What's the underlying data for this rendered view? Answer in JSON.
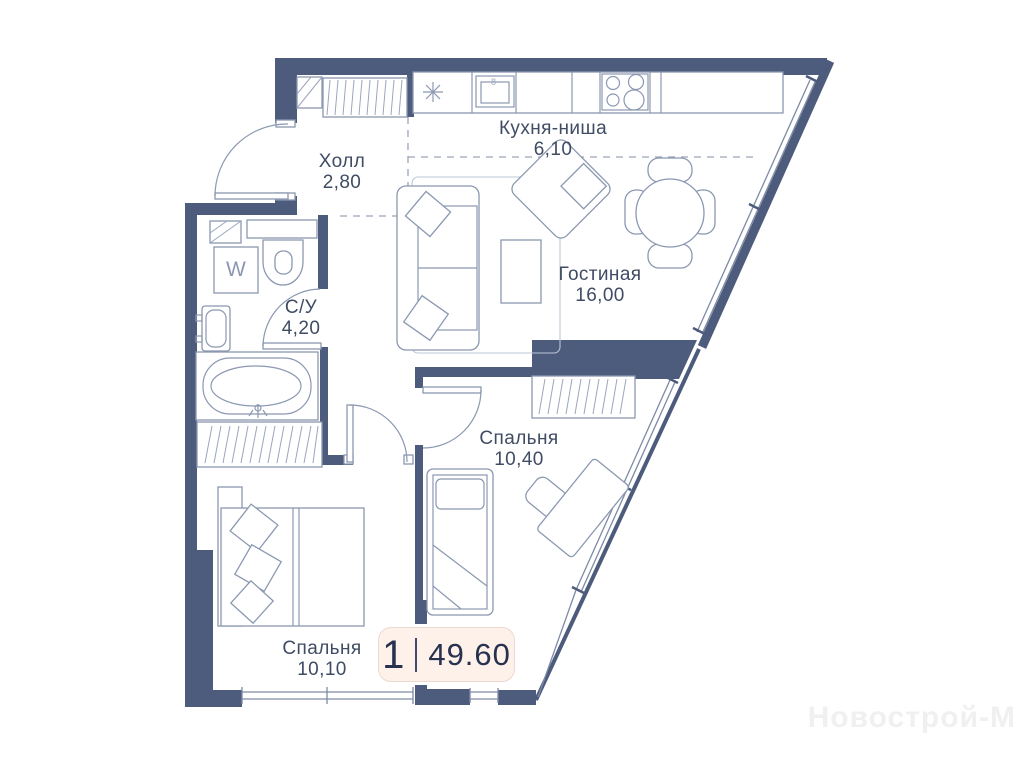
{
  "plan": {
    "rooms": [
      {
        "id": "kitchen",
        "name": "Кухня-ниша",
        "area": "6,10"
      },
      {
        "id": "hall",
        "name": "Холл",
        "area": "2,80"
      },
      {
        "id": "bathroom",
        "name": "С/У",
        "area": "4,20"
      },
      {
        "id": "living",
        "name": "Гостиная",
        "area": "16,00"
      },
      {
        "id": "bedroom-2",
        "name": "Спальня",
        "area": "10,40"
      },
      {
        "id": "bedroom-1",
        "name": "Спальня",
        "area": "10,10"
      }
    ],
    "badge": {
      "rooms_count": "1",
      "total_area": "49.60"
    },
    "appliances": {
      "washer_label": "W",
      "oven_label": "8"
    },
    "watermark": "Новострой-М",
    "colors": {
      "wall": "#4d5b7c",
      "furniture_line": "#8b98b1",
      "window_line": "#7d8aa6",
      "label_text": "#3f4c63",
      "badge_bg": "#fdf1ea",
      "badge_text": "#27324e"
    }
  }
}
